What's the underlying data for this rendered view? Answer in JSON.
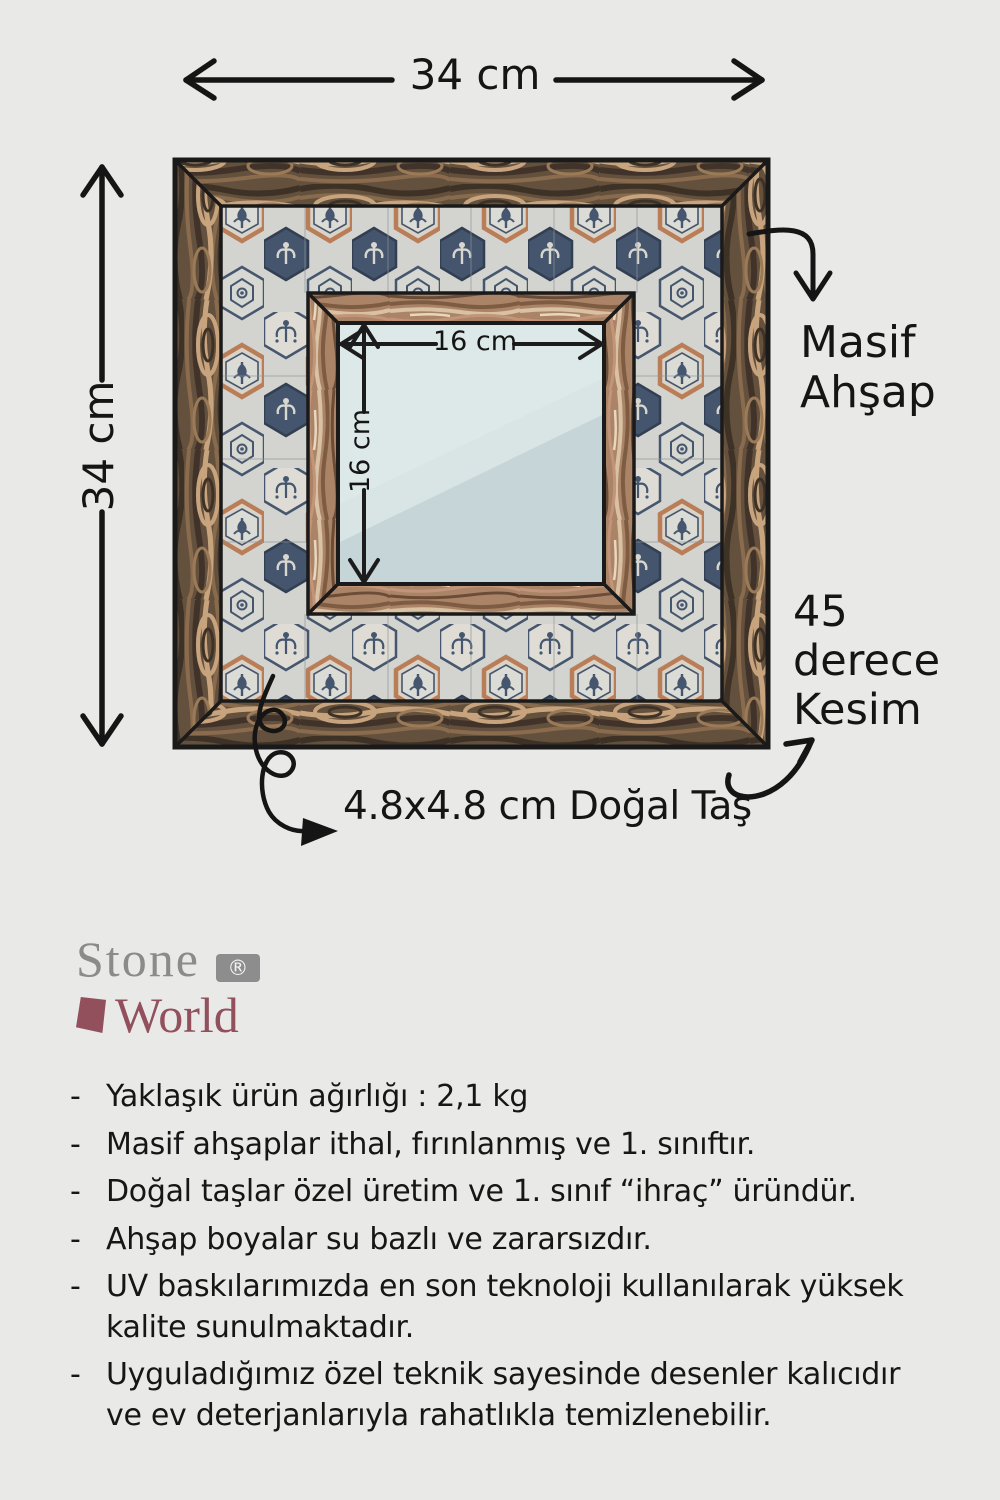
{
  "background": "#e9e9e8",
  "diagram": {
    "outer_width_label": "34 cm",
    "outer_height_label": "34 cm",
    "mirror_width_label": "16 cm",
    "mirror_height_label": "16 cm",
    "wood_annotation": "Masif\nAhşap",
    "cut_annotation": "45\nderece\nKesim",
    "stone_annotation": "4.8x4.8 cm Doğal Taş",
    "colors": {
      "annotation_ink": "#151515",
      "outer_wood_dark": "#63503d",
      "outer_wood_light": "#c7a47d",
      "inner_wood": "#ab8468",
      "tile_navy": "#45566e",
      "tile_terracotta": "#b97e58",
      "tile_cream": "#dcdcd6",
      "mirror_glass": "#c6d6d8"
    }
  },
  "logo": {
    "name_line1": "Stone",
    "registered_mark": "®",
    "name_line2": "World",
    "colors": {
      "stone_gray": "#8b8b8b",
      "world_maroon": "#91505c"
    }
  },
  "features": {
    "bullet": "-",
    "items": [
      "Yaklaşık ürün ağırlığı : 2,1 kg",
      "Masif ahşaplar ithal, fırınlanmış ve 1. sınıftır.",
      "Doğal taşlar özel üretim ve 1. sınıf “ihraç” üründür.",
      "Ahşap boyalar su bazlı ve zararsızdır.",
      "UV baskılarımızda en son teknoloji kullanılarak yüksek\nkalite sunulmaktadır.",
      "Uyguladığımız özel teknik sayesinde desenler kalıcıdır\nve ev deterjanlarıyla rahatlıkla temizlenebilir."
    ]
  }
}
